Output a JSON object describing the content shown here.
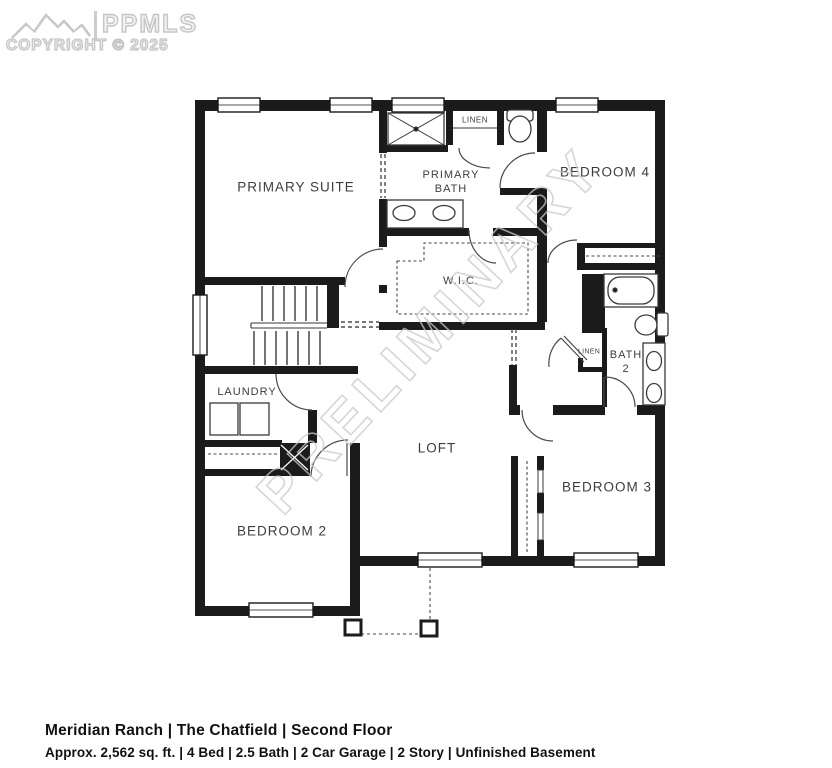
{
  "logo": {
    "brand": "PPMLS",
    "copyright": "COPYRIGHT © 2025"
  },
  "watermark": {
    "text": "PRELIMINARY"
  },
  "rooms": {
    "primary_suite": "PRIMARY SUITE",
    "primary_bath_l1": "PRIMARY",
    "primary_bath_l2": "BATH",
    "linen_top": "LINEN",
    "bedroom4": "BEDROOM 4",
    "wic": "W.I.C.",
    "bath2_l1": "BATH",
    "bath2_l2": "2",
    "linen_hall": "LINEN",
    "laundry": "LAUNDRY",
    "loft": "LOFT",
    "bedroom3": "BEDROOM 3",
    "bedroom2": "BEDROOM 2"
  },
  "footer": {
    "title": "Meridian Ranch | The Chatfield | Second Floor",
    "specs": "Approx. 2,562 sq. ft. | 4 Bed | 2.5 Bath | 2 Car Garage | 2 Story | Unfinished Basement"
  },
  "colors": {
    "wall": "#1b1b1b",
    "label": "#3d3d3d",
    "watermark_outline": "#c9c9c9",
    "footer_text": "#111111"
  }
}
